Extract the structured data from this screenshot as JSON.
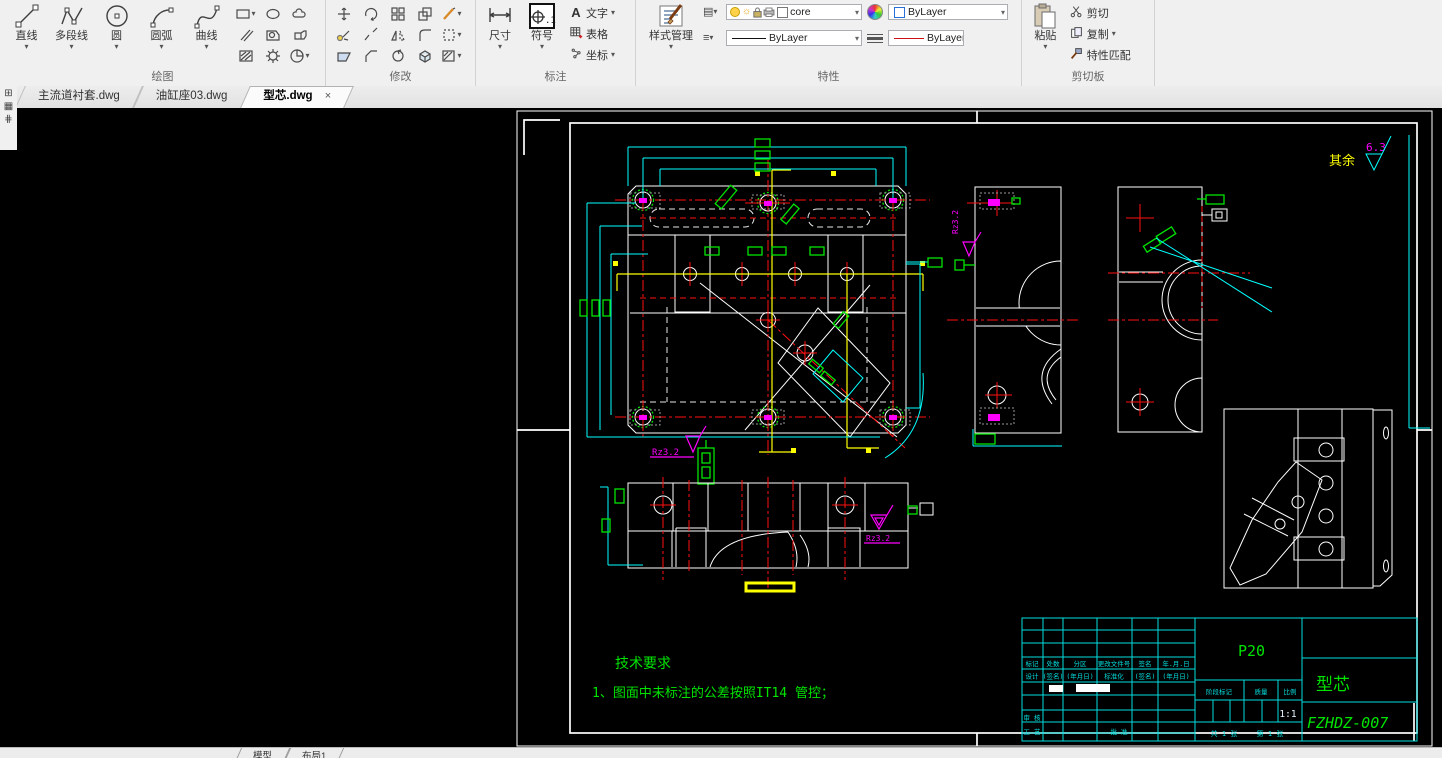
{
  "ribbon": {
    "draw": {
      "label": "绘图",
      "big": [
        {
          "label": "直线"
        },
        {
          "label": "多段线"
        },
        {
          "label": "圆"
        },
        {
          "label": "圆弧"
        },
        {
          "label": "曲线"
        }
      ]
    },
    "modify": {
      "label": "修改"
    },
    "annotate": {
      "label": "标注",
      "dim": "尺寸",
      "sym": "符号",
      "sym_glyph": ".1",
      "text_glyph": "A",
      "text_btn": "文字",
      "table_btn": "表格",
      "coord_btn": "坐标"
    },
    "props": {
      "label": "特性",
      "style_btn": "样式管理",
      "layer": "core",
      "color": "ByLayer",
      "linetype": "ByLayer",
      "lineweight": "ByLayer"
    },
    "clip": {
      "label": "剪切板",
      "paste": "粘贴",
      "cut": "剪切",
      "copy": "复制",
      "match": "特性匹配"
    }
  },
  "tabs": [
    {
      "label": "主流道衬套.dwg"
    },
    {
      "label": "油缸座03.dwg"
    },
    {
      "label": "型芯.dwg",
      "close": "×"
    }
  ],
  "drawing": {
    "surface_prefix": "其余",
    "surface_value": "6.3",
    "tech_title": "技术要求",
    "tech_line1": "1、图面中未标注的公差按照IT14 管控；",
    "roughness": "Rz3.2",
    "titleblock": {
      "material": "P20",
      "part_name": "型芯",
      "drawing_no": "FZHDZ-007",
      "cols": [
        "标记",
        "处数",
        "分区",
        "更改文件号",
        "签名",
        "年.月.日"
      ],
      "row2": [
        "设计",
        "(签名)",
        "(年月日)",
        "标准化",
        "(签名)",
        "(年月日)"
      ],
      "shenhe": "审 核",
      "gongyi": "工 艺",
      "pizhun": "批 准",
      "stage": "阶段标记",
      "mass": "质量",
      "scale": "比例",
      "scale_value": "1:1",
      "sheet_total": "共 1 张",
      "sheet_no": "第 1 张"
    },
    "model_tab": "模型",
    "layout_tab": "布局1"
  }
}
